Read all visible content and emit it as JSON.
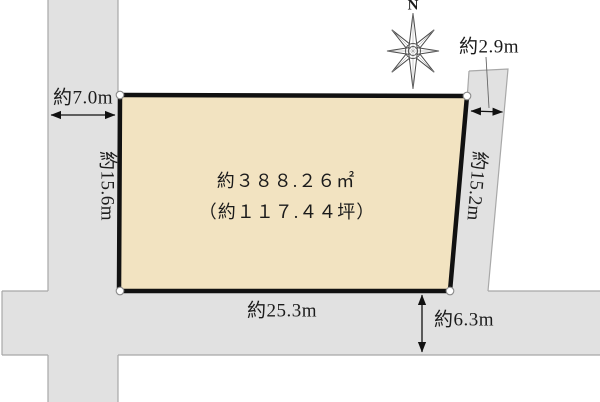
{
  "diagram": {
    "compass": {
      "label": "N"
    },
    "plot": {
      "area_sqm": "約３８８.２６㎡",
      "area_tsubo": "（約１１７.４４坪）"
    },
    "dimensions": {
      "west_road_width": "約7.0m",
      "west_boundary_length": "約15.6m",
      "east_road_width": "約2.9m",
      "east_boundary_length": "約15.2m",
      "south_boundary_length": "約25.3m",
      "south_road_width": "約6.3m"
    },
    "colors": {
      "plot_fill": "#f2e3c1",
      "plot_border": "#111111",
      "road_fill": "#e1e1e1",
      "road_edge": "#a8a8a8",
      "background": "#ffffff",
      "text": "#1b1b1b"
    }
  }
}
